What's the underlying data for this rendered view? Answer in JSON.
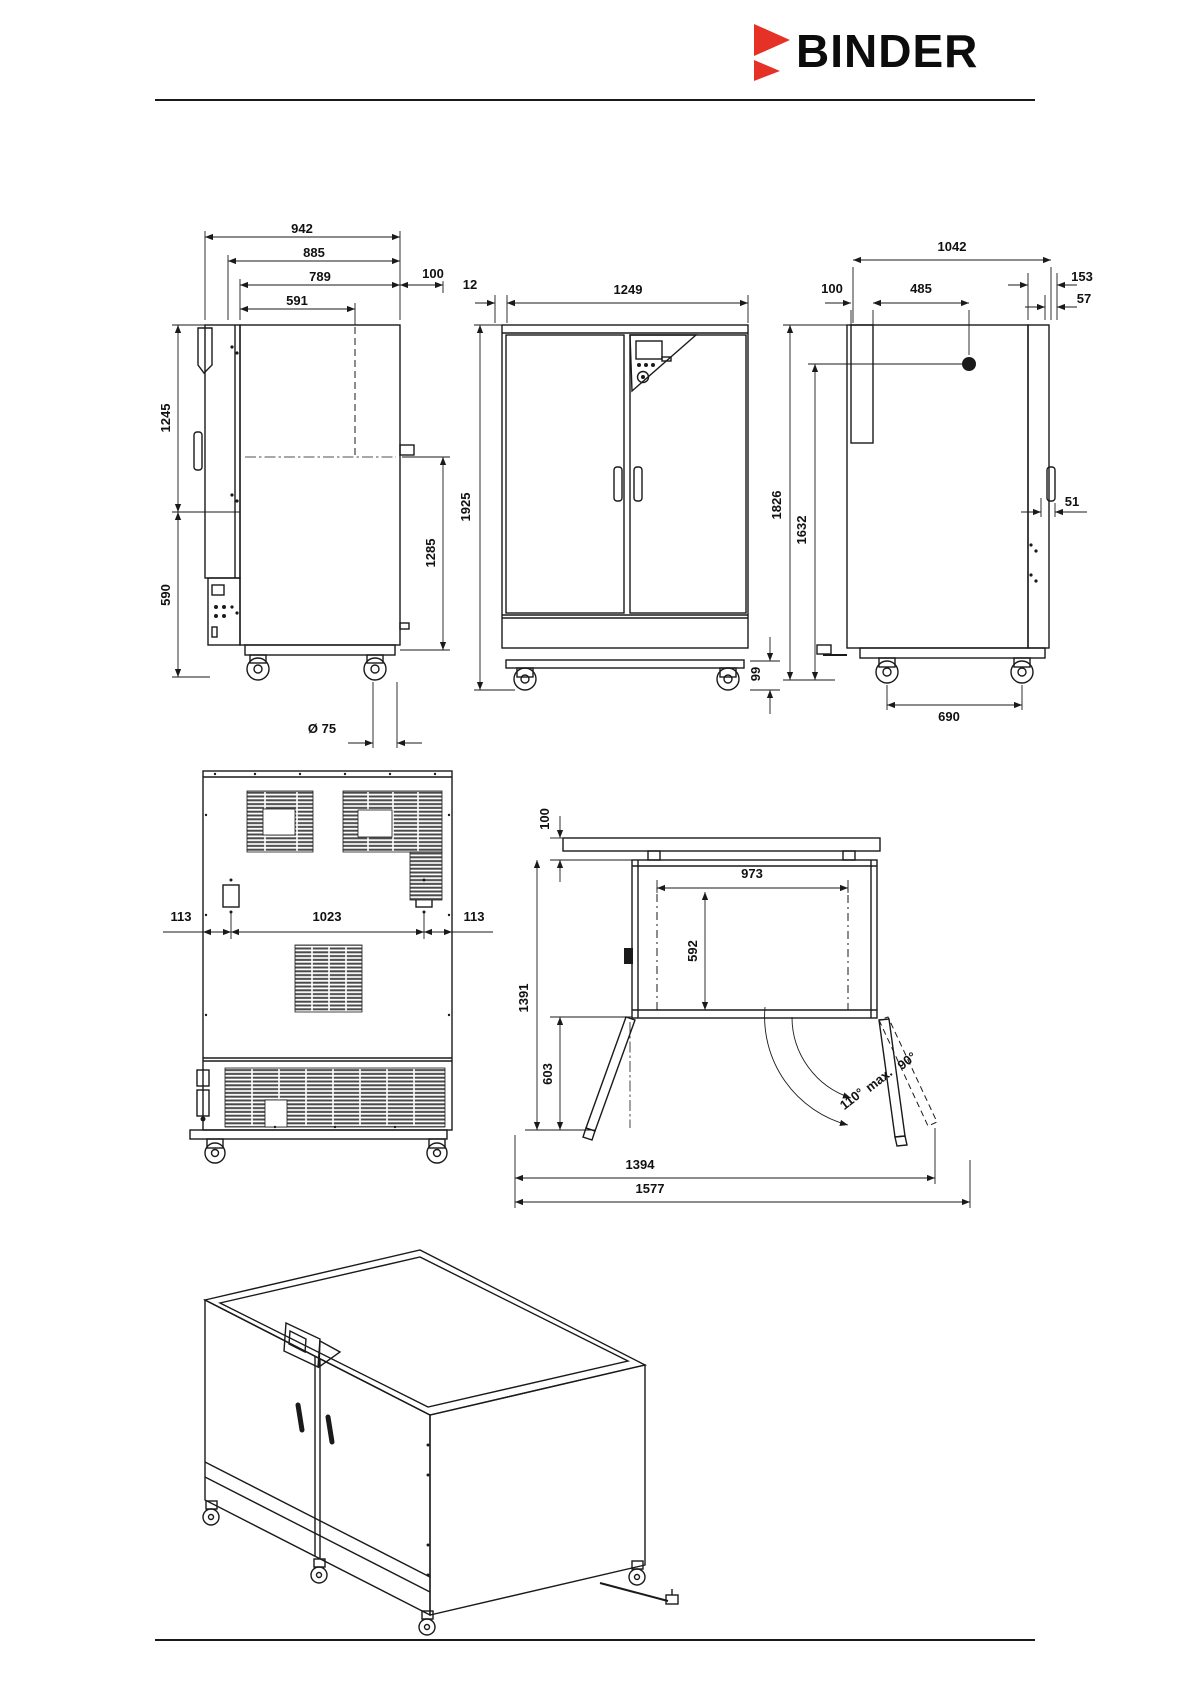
{
  "header": {
    "brand": "BINDER"
  },
  "colors": {
    "accent_red": "#e63226",
    "line": "#1a1a1a",
    "background": "#ffffff"
  },
  "views": {
    "side_left": {
      "total_depth": "942",
      "housing_depth": "885",
      "door_depth": "789",
      "interior_depth": "591",
      "wall_distance": "100",
      "height_upper": "1245",
      "height_lower": "590",
      "height_right": "1285",
      "caster_diameter": "Ø 75"
    },
    "front": {
      "door_offset": "12",
      "total_width": "1249",
      "total_height": "1925",
      "base_height": "99"
    },
    "side_right": {
      "total_depth": "1042",
      "wall_distance": "100",
      "port_offset": "485",
      "door_depth": "153",
      "handle_depth": "57",
      "total_height": "1826",
      "port_height": "1632",
      "handle_offset": "51",
      "caster_spacing": "690"
    },
    "rear": {
      "offset_left": "113",
      "anchor_spacing": "1023",
      "offset_right": "113"
    },
    "top": {
      "wall_distance": "100",
      "interior_width": "973",
      "interior_depth": "592",
      "total_depth": "1391",
      "door_depth": "603",
      "angle_90": "90°",
      "angle_max_label": "max.",
      "angle_110": "110°",
      "open_width_inner": "1394",
      "open_width_outer": "1577"
    }
  }
}
